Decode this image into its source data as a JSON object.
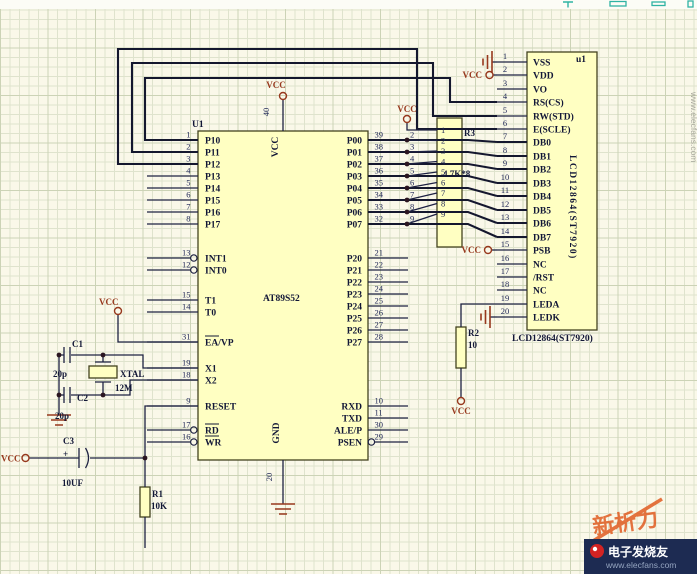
{
  "schematic": {
    "power": {
      "vcc": "VCC"
    },
    "mcu": {
      "ref": "U1",
      "part": "AT89S52",
      "top_pin": {
        "num": "40",
        "net": "VCC"
      },
      "bottom_pin": {
        "num": "20",
        "net": "GND"
      },
      "left_pins": [
        {
          "num": "1",
          "label": "P10"
        },
        {
          "num": "2",
          "label": "P11"
        },
        {
          "num": "3",
          "label": "P12"
        },
        {
          "num": "4",
          "label": "P13"
        },
        {
          "num": "5",
          "label": "P14"
        },
        {
          "num": "6",
          "label": "P15"
        },
        {
          "num": "7",
          "label": "P16"
        },
        {
          "num": "8",
          "label": "P17"
        },
        {
          "num": "13",
          "label": "INT1",
          "bubble": true
        },
        {
          "num": "12",
          "label": "INT0",
          "bubble": true
        },
        {
          "num": "15",
          "label": "T1"
        },
        {
          "num": "14",
          "label": "T0"
        },
        {
          "num": "31",
          "label": "EA/VP",
          "overline": "EA"
        },
        {
          "num": "19",
          "label": "X1"
        },
        {
          "num": "18",
          "label": "X2"
        },
        {
          "num": "9",
          "label": "RESET"
        },
        {
          "num": "17",
          "label": "RD",
          "overline": "RD",
          "bubble": true
        },
        {
          "num": "16",
          "label": "WR",
          "overline": "WR",
          "bubble": true
        }
      ],
      "right_pins": [
        {
          "num": "39",
          "label": "P00"
        },
        {
          "num": "38",
          "label": "P01"
        },
        {
          "num": "37",
          "label": "P02"
        },
        {
          "num": "36",
          "label": "P03"
        },
        {
          "num": "35",
          "label": "P04"
        },
        {
          "num": "34",
          "label": "P05"
        },
        {
          "num": "33",
          "label": "P06"
        },
        {
          "num": "32",
          "label": "P07"
        },
        {
          "num": "21",
          "label": "P20"
        },
        {
          "num": "22",
          "label": "P21"
        },
        {
          "num": "23",
          "label": "P22"
        },
        {
          "num": "24",
          "label": "P23"
        },
        {
          "num": "25",
          "label": "P24"
        },
        {
          "num": "26",
          "label": "P25"
        },
        {
          "num": "27",
          "label": "P26"
        },
        {
          "num": "28",
          "label": "P27"
        },
        {
          "num": "10",
          "label": "RXD"
        },
        {
          "num": "11",
          "label": "TXD"
        },
        {
          "num": "30",
          "label": "ALE/P"
        },
        {
          "num": "29",
          "label": "PSEN",
          "bubble": true
        }
      ]
    },
    "lcd": {
      "ref": "u1",
      "part": "LCD12864(ST7920)",
      "caption": "LCD12864(ST7920)",
      "pins": [
        {
          "num": "1",
          "label": "VSS"
        },
        {
          "num": "2",
          "label": "VDD"
        },
        {
          "num": "3",
          "label": "VO"
        },
        {
          "num": "4",
          "label": "RS(CS)"
        },
        {
          "num": "5",
          "label": "RW(STD)"
        },
        {
          "num": "6",
          "label": "E(SCLE)"
        },
        {
          "num": "7",
          "label": "DB0"
        },
        {
          "num": "8",
          "label": "DB1"
        },
        {
          "num": "9",
          "label": "DB2"
        },
        {
          "num": "10",
          "label": "DB3"
        },
        {
          "num": "11",
          "label": "DB4"
        },
        {
          "num": "12",
          "label": "DB5"
        },
        {
          "num": "13",
          "label": "DB6"
        },
        {
          "num": "14",
          "label": "DB7"
        },
        {
          "num": "15",
          "label": "PSB"
        },
        {
          "num": "16",
          "label": "NC"
        },
        {
          "num": "17",
          "label": "/RST"
        },
        {
          "num": "18",
          "label": "NC"
        },
        {
          "num": "19",
          "label": "LEDA"
        },
        {
          "num": "20",
          "label": "LEDK"
        }
      ]
    },
    "rnet": {
      "ref": "R3",
      "value": "4.7K*8",
      "pin_numbers": [
        "1",
        "2",
        "3",
        "4",
        "5",
        "6",
        "7",
        "8",
        "9"
      ],
      "tap_numbers": [
        "2",
        "3",
        "4",
        "5",
        "6",
        "7",
        "8",
        "9"
      ]
    },
    "r1": {
      "ref": "R1",
      "value": "10K"
    },
    "r2": {
      "ref": "R2",
      "value": "10"
    },
    "c1": {
      "ref": "C1",
      "value": "20p"
    },
    "c2": {
      "ref": "C2",
      "value": "20p"
    },
    "c3": {
      "ref": "C3",
      "value": "10UF",
      "plus": "+"
    },
    "xtal": {
      "ref": "XTAL",
      "value": "12M"
    }
  },
  "watermarks": {
    "side_url": "www.elecfans.com",
    "stamp_text": "新析力",
    "brand": "电子发烧友",
    "brand_url": "www.elecfans.com"
  }
}
